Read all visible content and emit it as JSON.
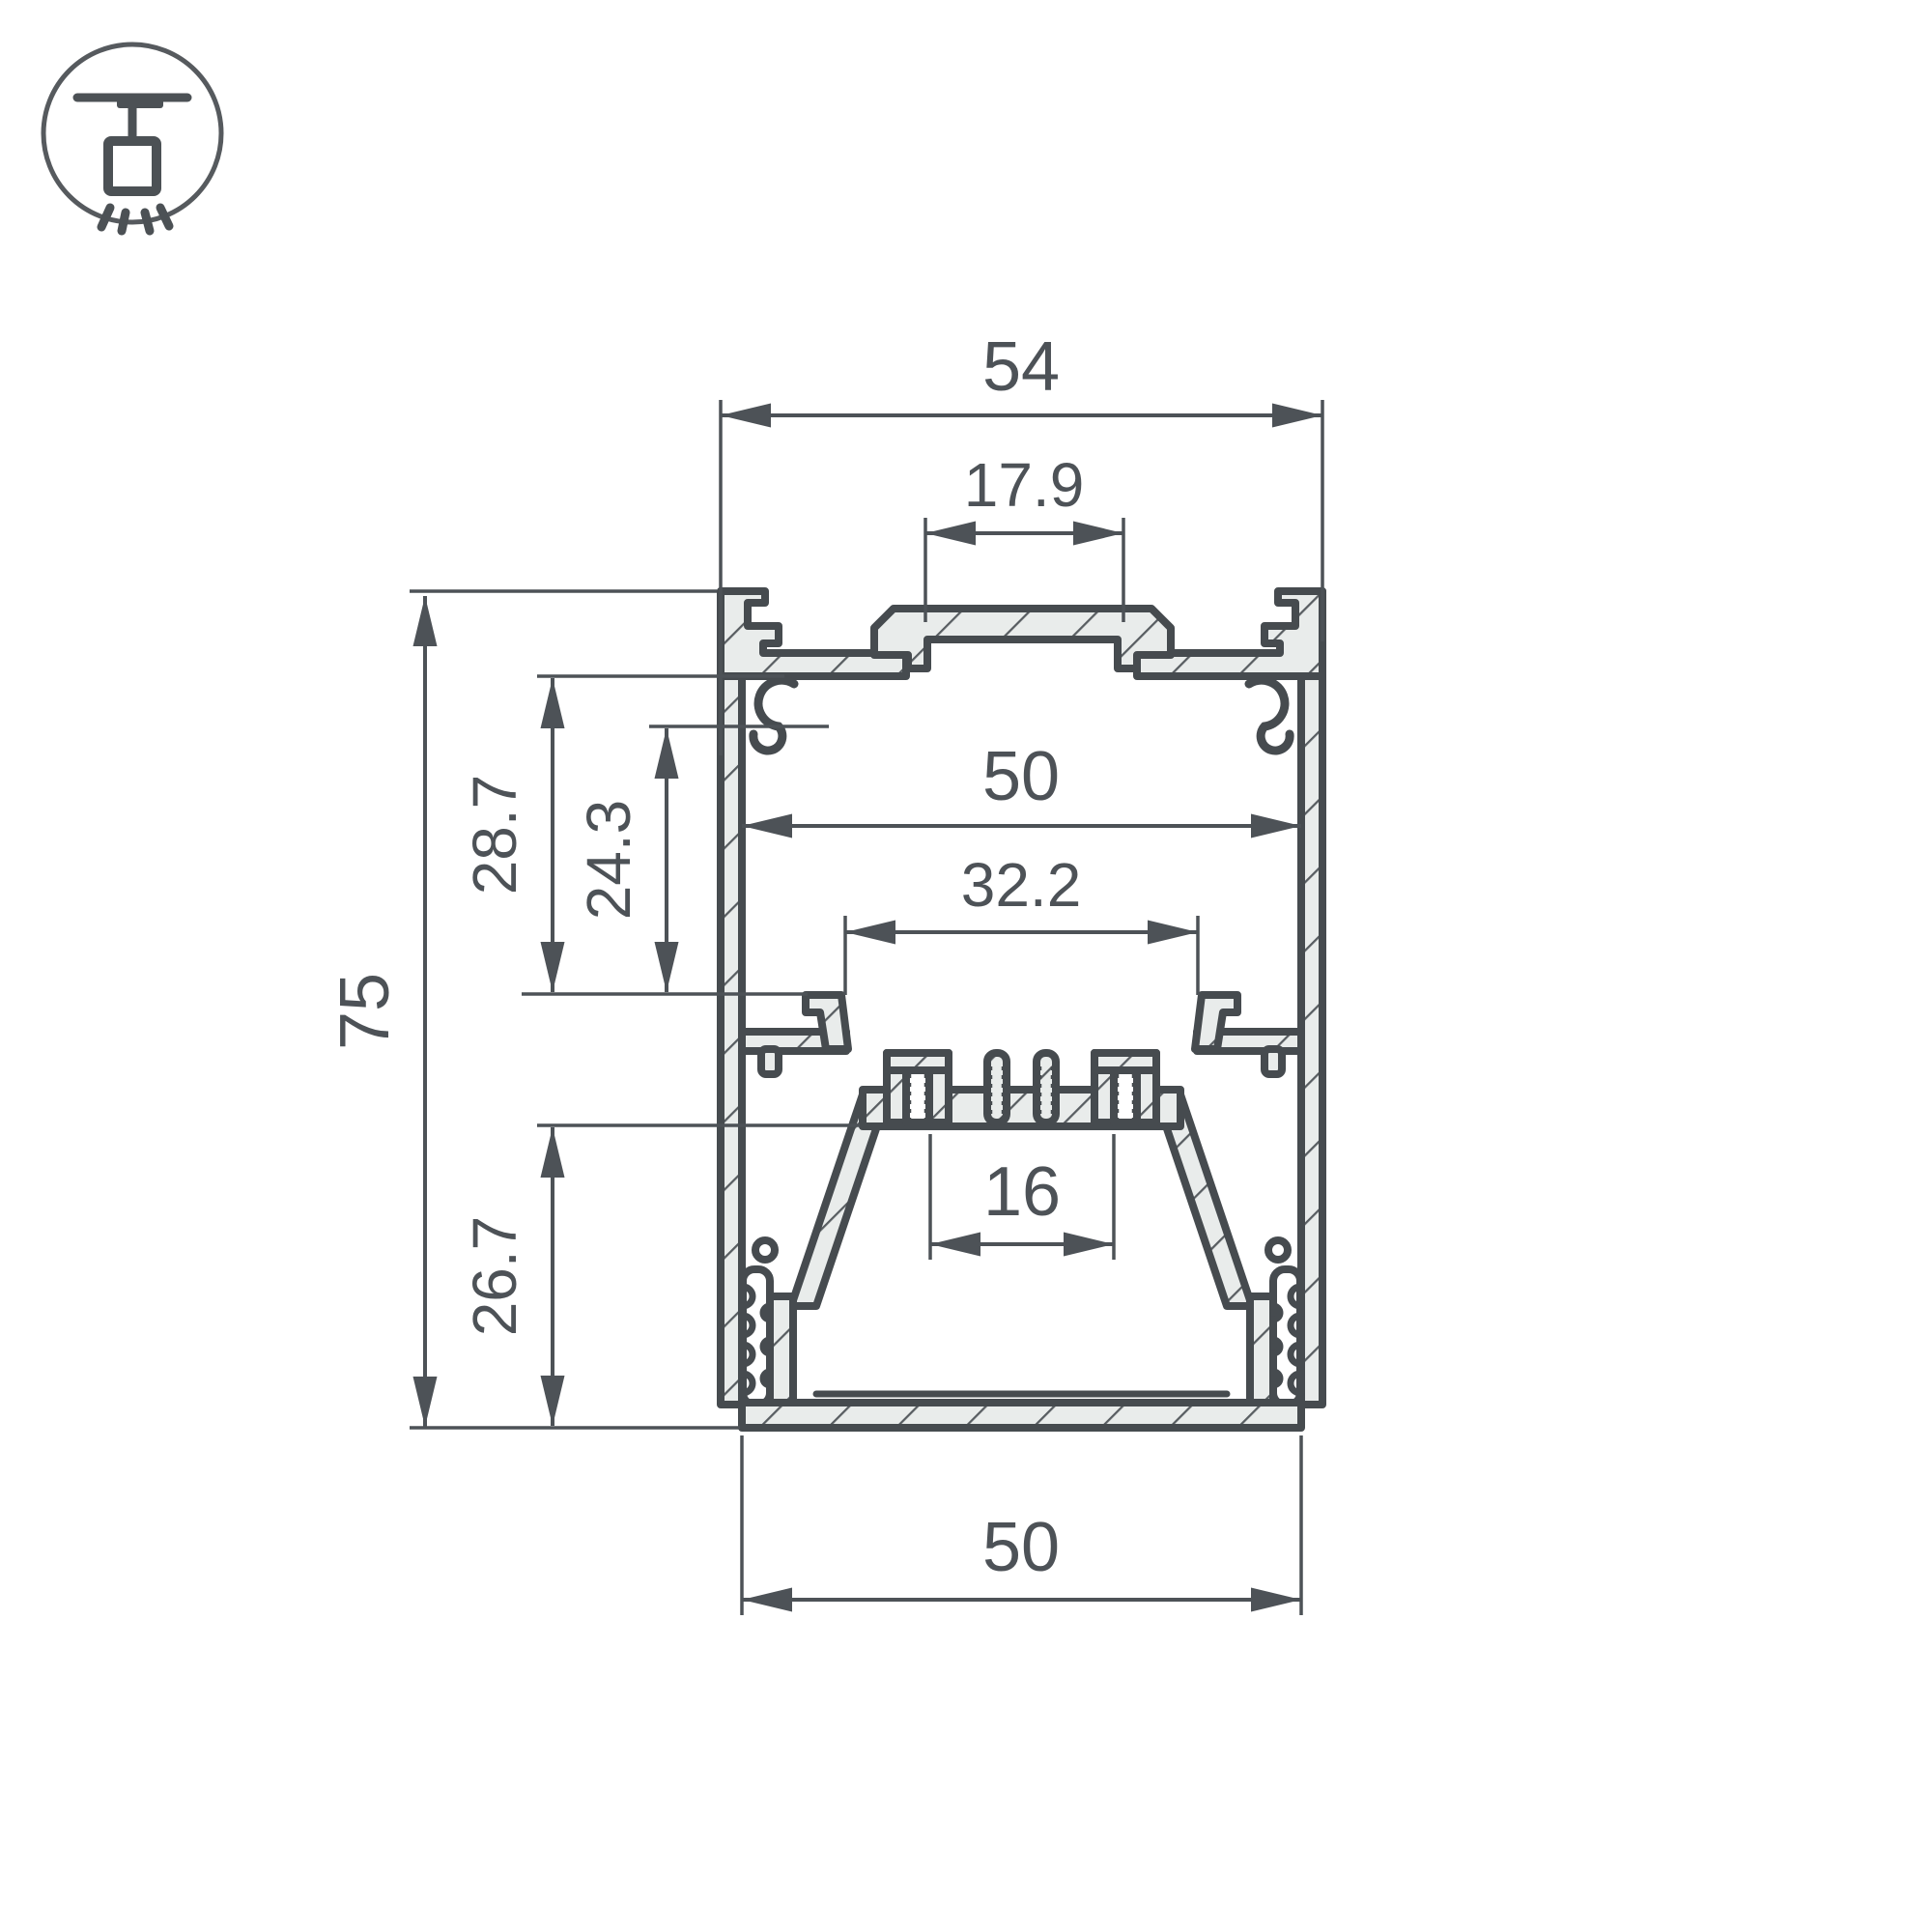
{
  "page": {
    "background_color": "#ffffff"
  },
  "drawing": {
    "subject": "Suspended linear LED profile cross-section",
    "colors": {
      "outline": "#464b4f",
      "metal_fill": "#e9eceb",
      "hatch": "#585d61",
      "dimension": "#4d5257"
    },
    "icon": {
      "name": "suspended-mount-icon",
      "meaning": "ceiling pendant mounting symbol"
    },
    "dims": {
      "top_width": "54",
      "cover_slot_width": "17.9",
      "inner_width": "50",
      "ledge_opening_width": "32.2",
      "led_channel_width": "16",
      "bottom_width": "50",
      "overall_height": "75",
      "upper_cavity_depth": "28.7",
      "inner_cavity_depth": "24.3",
      "lower_section_height": "26.7"
    }
  }
}
